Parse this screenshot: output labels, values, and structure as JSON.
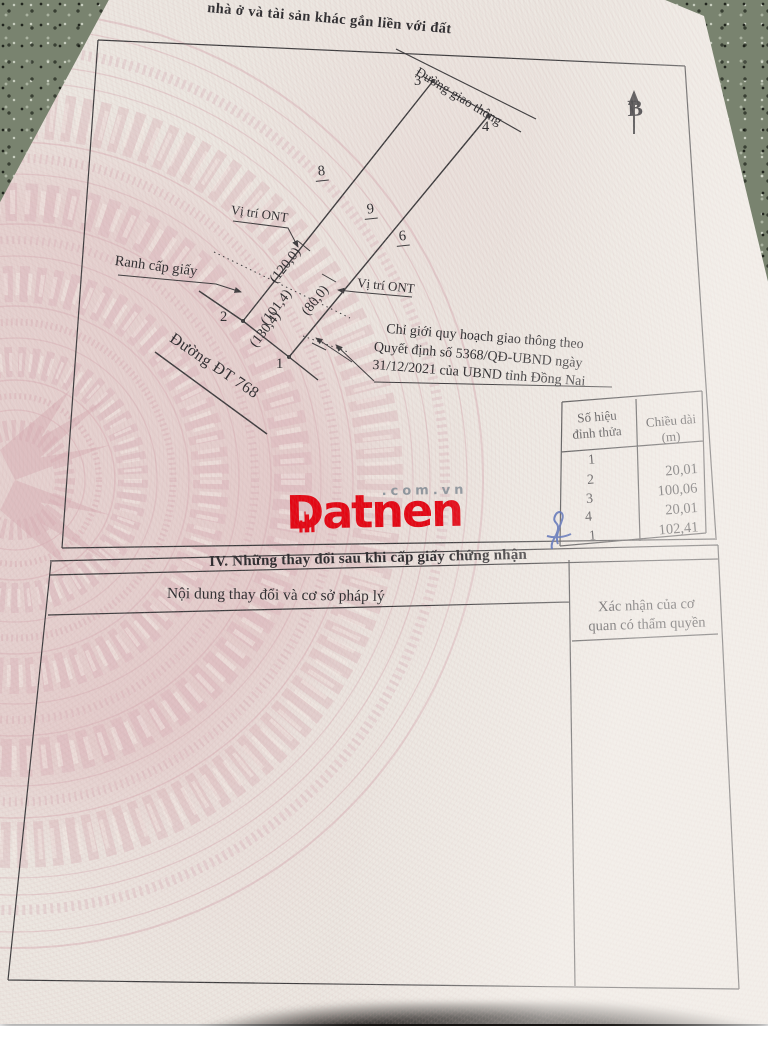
{
  "page": {
    "section_title_fragment": "nhà ở và tài sản khác gắn liền với đất"
  },
  "compass": {
    "north_label": "B"
  },
  "diagram": {
    "road_top": "Đường giao thông",
    "road_bottom": "Đường ĐT 768",
    "label_vi_tri_ont_top": "Vị trí ONT",
    "label_vi_tri_ont_right": "Vị trí ONT",
    "label_ranh_cap_giay": "Ranh cấp giấy",
    "vertex_1": "1",
    "vertex_2": "2",
    "vertex_3": "3",
    "vertex_4": "4",
    "adjacent_8": "8",
    "adjacent_9": "9",
    "adjacent_6": "6",
    "dim_120": "(120,0)",
    "dim_101": "(101,4)",
    "dim_130": "(130,4)",
    "dim_80": "(80,0)",
    "planning_line1": "Chỉ giới quy hoạch giao thông theo",
    "planning_line2": "Quyết định số 5368/QĐ-UBND ngày",
    "planning_line3": "31/12/2021 của UBND tỉnh Đồng Nai"
  },
  "vertex_table": {
    "header_col1_l1": "Số hiệu",
    "header_col1_l2": "đỉnh thửa",
    "header_col2_l1": "Chiều dài",
    "header_col2_l2": "(m)",
    "vertices": [
      "1",
      "2",
      "3",
      "4",
      "1"
    ],
    "lengths": [
      "20,01",
      "100,06",
      "20,01",
      "102,41"
    ]
  },
  "section_iv": {
    "heading": "IV. Những thay đổi sau khi cấp giấy chứng nhận",
    "col1_header": "Nội dung thay đổi và cơ sở pháp lý",
    "col2_header_l1": "Xác nhận của cơ",
    "col2_header_l2": "quan có thẩm quyền"
  },
  "watermark": {
    "brand": "Datnen",
    "suffix": ".com.vn",
    "brand_color": "#e30613"
  }
}
